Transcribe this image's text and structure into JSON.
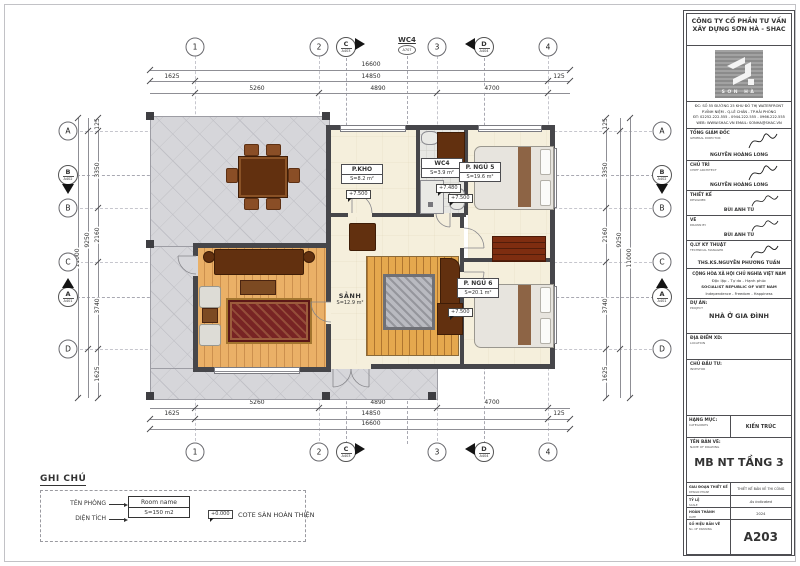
{
  "legend": {
    "title": "GHI CHÚ",
    "room_name_label": "TÊN PHÒNG",
    "room_name_value": "Room name",
    "area_label": "DIỆN TÍCH",
    "area_value": "S=150 m2",
    "cote_value": "+0.000",
    "cote_label": "COTE SÀN HOÀN THIỆN"
  },
  "rooms": {
    "kho": {
      "name": "P.KHO",
      "area": "S=8.2 m²",
      "level": "+7.500"
    },
    "wc": {
      "name": "WC4",
      "area": "S=3.9 m²",
      "level": "+7.480"
    },
    "ngu5": {
      "name": "P. NGỦ 5",
      "area": "S=19.6 m²",
      "level": "+7.500"
    },
    "sanh": {
      "name": "SẢNH",
      "area": "S=12.9 m²"
    },
    "ngu6": {
      "name": "P. NGỦ 6",
      "area": "S=20.1 m²",
      "level": "+7.500"
    }
  },
  "grid": {
    "c1": "1",
    "c2": "2",
    "c3": "3",
    "c4": "4",
    "rA": "A",
    "rB": "B",
    "rC": "C",
    "rD": "D",
    "secC": "C",
    "secC_ref": "A403",
    "secD": "D",
    "secD_ref": "A404",
    "secB": "B",
    "secB_ref": "A402",
    "secA": "A",
    "secA_ref": "A401",
    "wc_label": "WC4",
    "wc_ref": "A707"
  },
  "dims": {
    "total_h": "16600",
    "sub_h": "14850",
    "left_h": "1625",
    "right_h": "125",
    "s1": "5260",
    "s2": "4890",
    "s3": "4700",
    "total_v": "11000",
    "sub_v": "9250",
    "v0": "125",
    "v1": "3350",
    "v2": "2160",
    "v3": "3740",
    "v4": "1625"
  },
  "titleblock": {
    "company1": "CÔNG TY CỔ PHẦN TƯ VẤN",
    "company2": "XÂY DỰNG SƠN HÀ - SHAC",
    "logo_text": "SƠN HÀ",
    "addr1": "ĐC: SỐ 55 ĐƯỜNG 25 KHU ĐÔ THỊ WATERFRONT",
    "addr2": "P.VĨNH NIỆM - Q.LÊ CHÂN - TP.HẢI PHÒNG",
    "addr3": "ĐT: 02252.222.555 - 0944.222.555 - 0966.222.555",
    "addr4": "WEB: WWW.SHAC.VN EMAIL: SONHA@SHAC.VN",
    "roles": [
      {
        "vi": "TỔNG GIÁM ĐỐC",
        "en": "GENERAL DIRECTOR",
        "name": "NGUYỄN HOÀNG LONG"
      },
      {
        "vi": "CHỦ TRÌ",
        "en": "CHIEF ARCHITECT",
        "name": "NGUYỄN HOÀNG LONG"
      },
      {
        "vi": "THIẾT KẾ",
        "en": "DESIGNER",
        "name": "BÙI ANH TÚ"
      },
      {
        "vi": "VẼ",
        "en": "DRAWN BY",
        "name": "BÙI ANH TÚ"
      },
      {
        "vi": "Q.LÝ KỸ THUẬT",
        "en": "TECHNICAL MANAGER",
        "name": "THS.KS.NGUYỄN PHƯƠNG TUẤN"
      }
    ],
    "motto1": "CỘNG HÒA XÃ HỘI CHỦ NGHĨA VIỆT NAM",
    "motto2": "Độc lập - Tự do - Hạnh phúc",
    "motto3": "SOCIALIST REPUBLIC OF VIET NAM",
    "motto4": "Independence - Freedom - Happiness",
    "project_vi": "DỰ ÁN:",
    "project_en": "PROJECT",
    "project_value": "NHÀ Ở GIA ĐÌNH",
    "location_vi": "ĐỊA ĐIỂM XD:",
    "location_en": "LOCATION",
    "investor_vi": "CHỦ ĐẦU TƯ:",
    "investor_en": "INVESTOR",
    "category_vi": "HẠNG MỤC:",
    "category_en": "CATEGORIES",
    "category_value": "KIẾN TRÚC",
    "name_vi": "TÊN BẢN VẼ:",
    "name_en": "NAME OF DRAWING",
    "name_value": "MB NT TẦNG 3",
    "phase_vi": "GIAI ĐOẠN THIẾT KẾ",
    "phase_en": "DESIGN PHASE",
    "phase_value": "THIẾT KẾ BẢN VẼ THI CÔNG",
    "scale_vi": "TỶ LỆ",
    "scale_en": "SCALE",
    "scale_value": "As indicated",
    "date_vi": "HOÀN THÀNH",
    "date_en": "DATE",
    "date_value": "2024",
    "no_vi": "SỐ HIỆU BẢN VẼ",
    "no_en": "No. OF DRAWING",
    "no_value": "A203"
  }
}
